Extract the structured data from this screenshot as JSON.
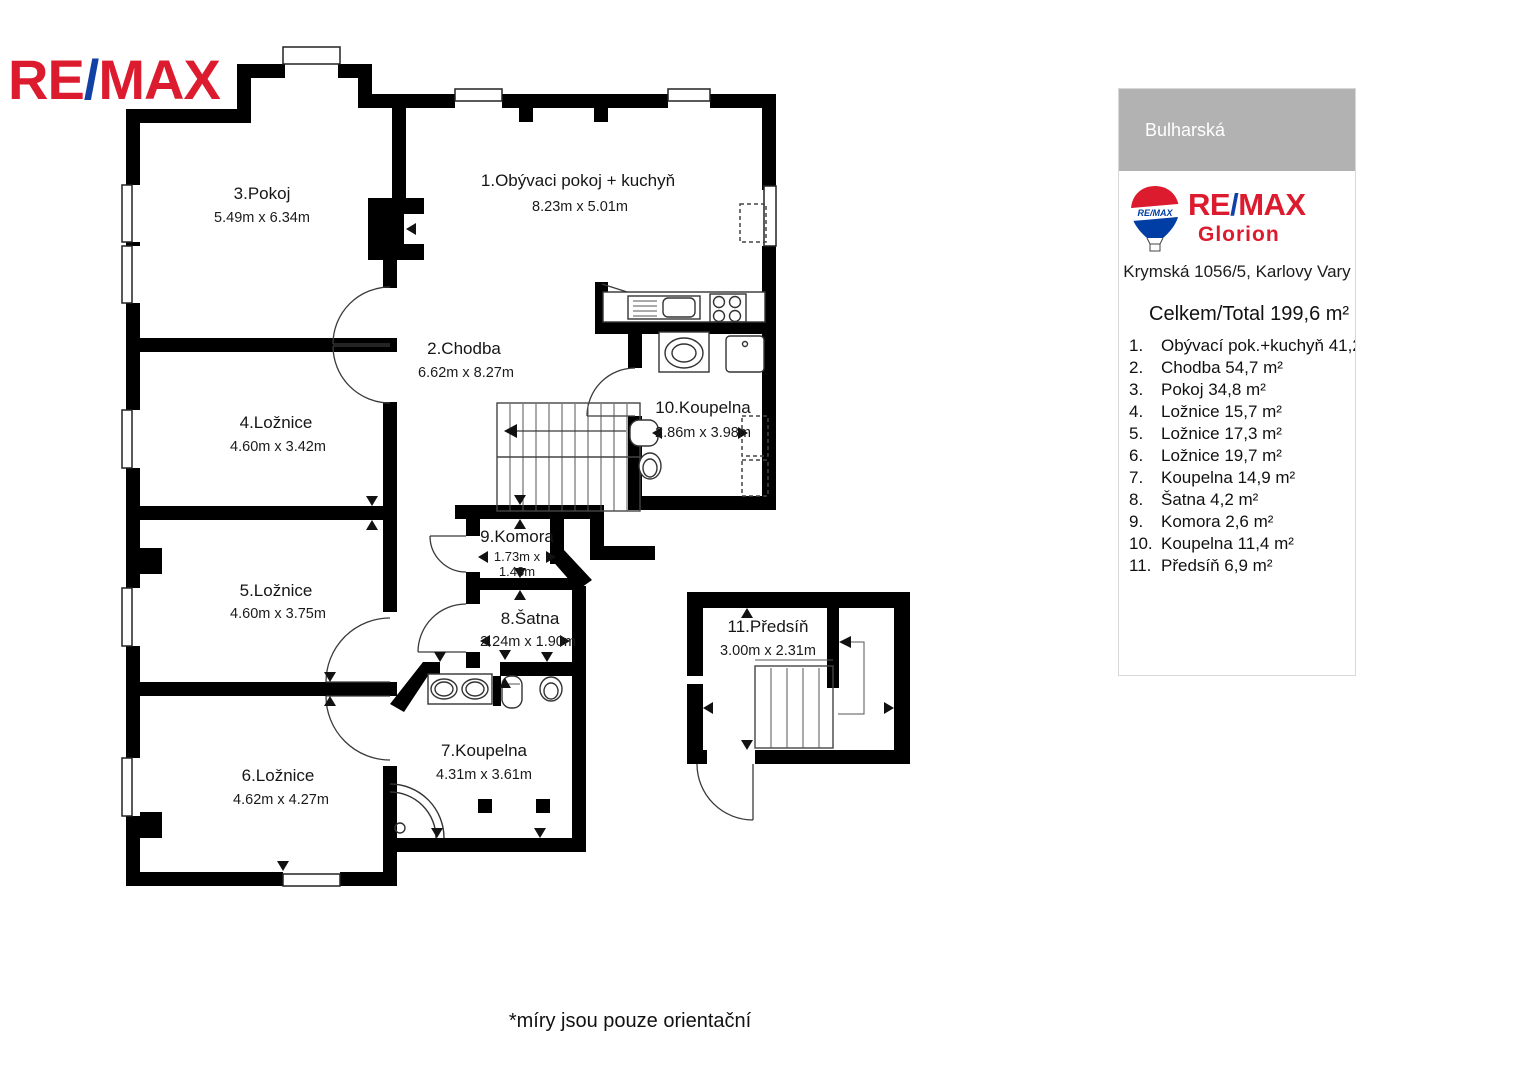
{
  "logo": {
    "re": "RE",
    "slash": "/",
    "max": "MAX"
  },
  "sidebar": {
    "street": "Bulharská",
    "brand": {
      "re": "RE",
      "slash": "/",
      "max": "MAX",
      "office": "Glorion",
      "balloon_text": "RE/MAX"
    },
    "address": "Krymská 1056/5, Karlovy Vary",
    "total": "Celkem/Total  199,6 m²",
    "rooms": [
      {
        "num": "1.",
        "label": "Obývací pok.+kuchyň 41,2"
      },
      {
        "num": "2.",
        "label": "Chodba 54,7 m²"
      },
      {
        "num": "3.",
        "label": "Pokoj 34,8 m²"
      },
      {
        "num": "4.",
        "label": "Ložnice 15,7 m²"
      },
      {
        "num": "5.",
        "label": "Ložnice 17,3 m²"
      },
      {
        "num": "6.",
        "label": "Ložnice 19,7 m²"
      },
      {
        "num": "7.",
        "label": "Koupelna 14,9 m²"
      },
      {
        "num": "8.",
        "label": "Šatna 4,2 m²"
      },
      {
        "num": "9.",
        "label": "Komora 2,6 m²"
      },
      {
        "num": "10.",
        "label": "Koupelna 11,4 m²"
      },
      {
        "num": "11.",
        "label": "Předsíň 6,9 m²"
      }
    ]
  },
  "plan": {
    "rooms": [
      {
        "name": "3.Pokoj",
        "dims": "5.49m x 6.34m"
      },
      {
        "name": "1.Obývaci pokoj + kuchyň",
        "dims": "8.23m x 5.01m"
      },
      {
        "name": "2.Chodba",
        "dims": "6.62m x 8.27m"
      },
      {
        "name": "4.Ložnice",
        "dims": "4.60m x 3.42m"
      },
      {
        "name": "10.Koupelna",
        "dims": "2.86m x 3.98m"
      },
      {
        "name": "9.Komora",
        "dims_line1": "1.73m x",
        "dims_line2": "1.48m"
      },
      {
        "name": "8.Šatna",
        "dims": "2.24m x 1.90m"
      },
      {
        "name": "5.Ložnice",
        "dims": "4.60m x 3.75m"
      },
      {
        "name": "6.Ložnice",
        "dims": "4.62m x 4.27m"
      },
      {
        "name": "7.Koupelna",
        "dims": "4.31m x 3.61m"
      },
      {
        "name": "11.Předsíň",
        "dims": "3.00m x 2.31m"
      }
    ],
    "footnote": "*míry jsou pouze orientační"
  },
  "colors": {
    "remax_red": "#dc1c2e",
    "remax_blue": "#003da5",
    "header_gray": "#b2b2b2"
  }
}
